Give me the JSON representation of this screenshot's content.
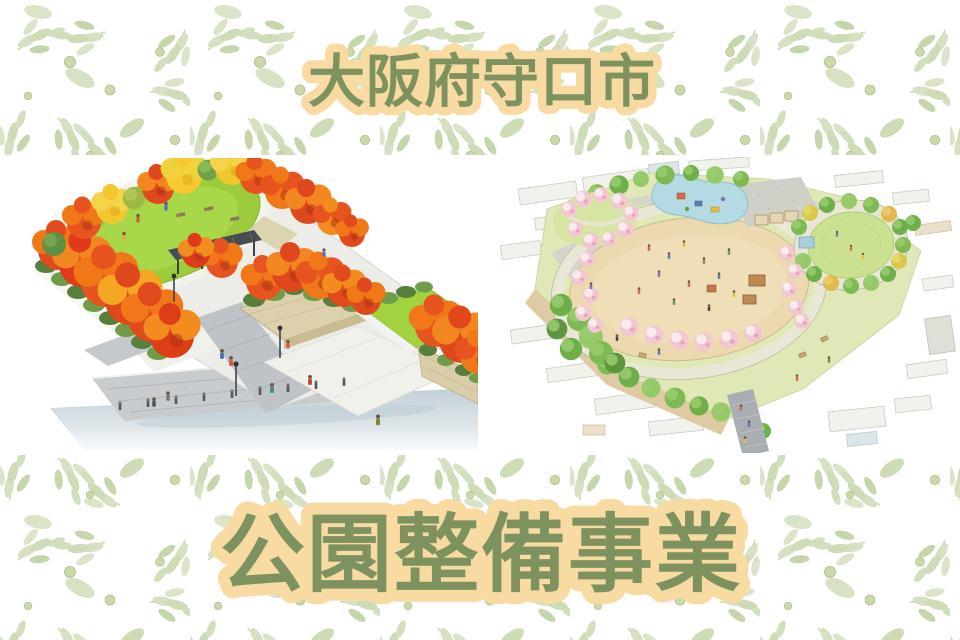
{
  "banner": {
    "top_title": "大阪府守口市",
    "main_title": "公園整備事業"
  },
  "colors": {
    "title_text_green": "#7E9260",
    "title_highlight_peach": "#F8DBA3",
    "leaf_pattern_light": "#D7E2C4",
    "leaf_pattern_mid": "#C6D6AC",
    "band_background": "#FFFFFF",
    "autumn_red": "#DF471C",
    "autumn_orange": "#F07818",
    "ginkgo_yellow": "#F2C830",
    "lawn_green": "#9CCB3B",
    "plan_field_tan": "#EDD9B0",
    "plan_pond_blue": "#B4DBE3",
    "cherry_pink": "#F2C7D1"
  },
  "illustrations": {
    "left": "autumn-park-perspective-rendering",
    "right": "park-site-plan-watercolor-aerial"
  }
}
